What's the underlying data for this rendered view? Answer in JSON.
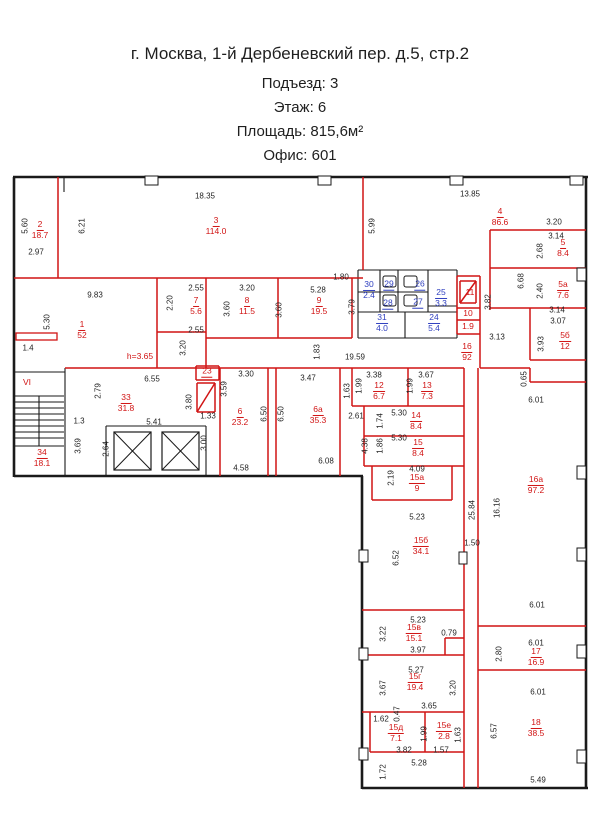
{
  "header": {
    "line1": "г. Москва, 1-й Дербеневский пер. д.5, стр.2",
    "line2": "Подъезд: 3",
    "line3": "Этаж: 6",
    "line4": "Площадь: 815,6м²",
    "line5": "Офис: 601"
  },
  "colors": {
    "wall_black": "#1a1a1a",
    "wall_red": "#d11414",
    "label_red": "#d11414",
    "label_blue": "#2f3fbf",
    "dim_text": "#1f1f1f"
  },
  "plan": {
    "walls_black_thick": [
      [
        13,
        177,
        588,
        177
      ],
      [
        14,
        177,
        14,
        477
      ],
      [
        14,
        476,
        363,
        476
      ],
      [
        362,
        476,
        362,
        789
      ],
      [
        362,
        788,
        588,
        788
      ],
      [
        586,
        177,
        586,
        788
      ]
    ],
    "walls_black_thin": [
      [
        64,
        177,
        64,
        192
      ],
      [
        65,
        368,
        65,
        476
      ],
      [
        14,
        372,
        65,
        372
      ],
      [
        14,
        396,
        64,
        396
      ],
      [
        14,
        446,
        64,
        446
      ],
      [
        39,
        396,
        39,
        446
      ],
      [
        14,
        402,
        64,
        402
      ],
      [
        14,
        408,
        64,
        408
      ],
      [
        14,
        414,
        64,
        414
      ],
      [
        14,
        420,
        64,
        420
      ],
      [
        14,
        426,
        64,
        426
      ],
      [
        14,
        432,
        64,
        432
      ],
      [
        14,
        438,
        64,
        438
      ],
      [
        106,
        426,
        206,
        426
      ],
      [
        106,
        426,
        106,
        476
      ],
      [
        206,
        426,
        206,
        476
      ],
      [
        358,
        270,
        457,
        270
      ],
      [
        358,
        270,
        358,
        338
      ],
      [
        358,
        338,
        457,
        338
      ],
      [
        457,
        270,
        457,
        338
      ],
      [
        380,
        270,
        380,
        312
      ],
      [
        398,
        270,
        398,
        312
      ],
      [
        428,
        270,
        428,
        312
      ],
      [
        358,
        292,
        428,
        292
      ],
      [
        358,
        312,
        457,
        312
      ],
      [
        405,
        312,
        405,
        338
      ],
      [
        428,
        306,
        457,
        306
      ]
    ],
    "walls_red": [
      [
        58,
        177,
        58,
        278
      ],
      [
        14,
        278,
        363,
        278
      ],
      [
        157,
        278,
        157,
        368
      ],
      [
        206,
        278,
        206,
        368
      ],
      [
        278,
        278,
        278,
        338
      ],
      [
        352,
        278,
        352,
        338
      ],
      [
        206,
        338,
        352,
        338
      ],
      [
        157,
        332,
        206,
        332
      ],
      [
        65,
        368,
        464,
        368
      ],
      [
        363,
        177,
        363,
        270
      ],
      [
        457,
        276,
        480,
        276
      ],
      [
        480,
        276,
        480,
        334
      ],
      [
        457,
        334,
        480,
        334
      ],
      [
        457,
        308,
        480,
        308
      ],
      [
        457,
        320,
        480,
        320
      ],
      [
        457,
        276,
        457,
        334
      ],
      [
        460,
        281,
        476,
        281
      ],
      [
        460,
        281,
        460,
        303
      ],
      [
        476,
        281,
        476,
        303
      ],
      [
        460,
        303,
        476,
        303
      ],
      [
        460,
        303,
        476,
        281
      ],
      [
        490,
        230,
        586,
        230
      ],
      [
        490,
        230,
        490,
        310
      ],
      [
        490,
        268,
        586,
        268
      ],
      [
        490,
        308,
        586,
        308
      ],
      [
        530,
        308,
        530,
        360
      ],
      [
        530,
        360,
        586,
        360
      ],
      [
        480,
        334,
        480,
        368
      ],
      [
        480,
        368,
        530,
        368
      ],
      [
        530,
        368,
        530,
        382
      ],
      [
        530,
        382,
        586,
        382
      ],
      [
        220,
        368,
        220,
        476
      ],
      [
        196,
        366,
        219,
        366
      ],
      [
        196,
        366,
        196,
        380
      ],
      [
        219,
        366,
        219,
        380
      ],
      [
        196,
        380,
        219,
        380
      ],
      [
        197,
        383,
        215,
        383
      ],
      [
        197,
        383,
        197,
        412
      ],
      [
        215,
        383,
        215,
        412
      ],
      [
        197,
        412,
        215,
        412
      ],
      [
        197,
        412,
        215,
        383
      ],
      [
        268,
        368,
        268,
        476
      ],
      [
        276,
        368,
        276,
        476
      ],
      [
        340,
        368,
        340,
        476
      ],
      [
        352,
        368,
        352,
        406
      ],
      [
        408,
        368,
        408,
        406
      ],
      [
        352,
        406,
        464,
        406
      ],
      [
        364,
        406,
        364,
        466
      ],
      [
        364,
        436,
        464,
        436
      ],
      [
        364,
        466,
        464,
        466
      ],
      [
        372,
        466,
        372,
        500
      ],
      [
        452,
        466,
        452,
        500
      ],
      [
        372,
        500,
        452,
        500
      ],
      [
        464,
        368,
        464,
        788
      ],
      [
        478,
        368,
        478,
        788
      ],
      [
        362,
        610,
        464,
        610
      ],
      [
        362,
        655,
        464,
        655
      ],
      [
        445,
        638,
        445,
        655
      ],
      [
        445,
        638,
        464,
        638
      ],
      [
        362,
        712,
        464,
        712
      ],
      [
        370,
        712,
        370,
        752
      ],
      [
        425,
        712,
        425,
        752
      ],
      [
        370,
        752,
        464,
        752
      ],
      [
        478,
        626,
        586,
        626
      ],
      [
        478,
        670,
        586,
        670
      ]
    ],
    "boxes_red": [
      {
        "x": 16,
        "y": 333,
        "w": 41,
        "h": 7
      }
    ],
    "tabs": [
      {
        "x": 145,
        "y": 176,
        "w": 13,
        "h": 9
      },
      {
        "x": 318,
        "y": 176,
        "w": 13,
        "h": 9
      },
      {
        "x": 450,
        "y": 176,
        "w": 13,
        "h": 9
      },
      {
        "x": 570,
        "y": 176,
        "w": 13,
        "h": 9
      },
      {
        "x": 577,
        "y": 268,
        "w": 9,
        "h": 13
      },
      {
        "x": 577,
        "y": 466,
        "w": 9,
        "h": 13
      },
      {
        "x": 577,
        "y": 548,
        "w": 9,
        "h": 13
      },
      {
        "x": 577,
        "y": 645,
        "w": 9,
        "h": 13
      },
      {
        "x": 577,
        "y": 750,
        "w": 9,
        "h": 13
      },
      {
        "x": 359,
        "y": 550,
        "w": 9,
        "h": 12
      },
      {
        "x": 359,
        "y": 648,
        "w": 9,
        "h": 12
      },
      {
        "x": 359,
        "y": 748,
        "w": 9,
        "h": 12
      },
      {
        "x": 459,
        "y": 552,
        "w": 8,
        "h": 12
      }
    ],
    "elevators": [
      {
        "x": 114,
        "y": 432,
        "w": 37,
        "h": 38
      },
      {
        "x": 162,
        "y": 432,
        "w": 37,
        "h": 38
      }
    ],
    "fixtures": [
      {
        "x": 383,
        "y": 276,
        "w": 13,
        "h": 11
      },
      {
        "x": 404,
        "y": 276,
        "w": 13,
        "h": 11
      },
      {
        "x": 383,
        "y": 295,
        "w": 13,
        "h": 11
      },
      {
        "x": 404,
        "y": 295,
        "w": 13,
        "h": 11
      }
    ],
    "rooms": [
      {
        "n": "2",
        "a": "18.7",
        "x": 40,
        "y": 230,
        "c": "r"
      },
      {
        "n": "3",
        "a": "114.0",
        "x": 216,
        "y": 226,
        "c": "r"
      },
      {
        "n": "4",
        "a": "86.6",
        "x": 500,
        "y": 217,
        "c": "r"
      },
      {
        "n": "5",
        "a": "8.4",
        "x": 563,
        "y": 248,
        "c": "r"
      },
      {
        "n": "5а",
        "a": "7.6",
        "x": 563,
        "y": 290,
        "c": "r"
      },
      {
        "n": "5б",
        "a": "12",
        "x": 565,
        "y": 341,
        "c": "r"
      },
      {
        "n": "1",
        "a": "52",
        "x": 82,
        "y": 330,
        "c": "r"
      },
      {
        "n": "7",
        "a": "5.6",
        "x": 196,
        "y": 306,
        "c": "r"
      },
      {
        "n": "8",
        "a": "11.5",
        "x": 247,
        "y": 306,
        "c": "r"
      },
      {
        "n": "9",
        "a": "19.5",
        "x": 319,
        "y": 306,
        "c": "r"
      },
      {
        "n": "11",
        "a": "",
        "x": 470,
        "y": 293,
        "c": "r"
      },
      {
        "n": "10",
        "a": "",
        "x": 468,
        "y": 314,
        "c": "r"
      },
      {
        "n": "1.9",
        "a": "",
        "x": 468,
        "y": 327,
        "c": "r"
      },
      {
        "n": "16",
        "a": "92",
        "x": 467,
        "y": 352,
        "c": "r"
      },
      {
        "n": "30",
        "a": "2.4",
        "x": 369,
        "y": 290,
        "c": "b"
      },
      {
        "n": "29",
        "a": "",
        "u": true,
        "x": 389,
        "y": 285,
        "c": "b"
      },
      {
        "n": "26",
        "a": "",
        "u": true,
        "x": 420,
        "y": 285,
        "c": "b"
      },
      {
        "n": "25",
        "a": "3.3",
        "x": 441,
        "y": 298,
        "c": "b"
      },
      {
        "n": "28",
        "a": "",
        "u": true,
        "x": 388,
        "y": 304,
        "c": "b"
      },
      {
        "n": "27",
        "a": "",
        "u": true,
        "x": 418,
        "y": 303,
        "c": "b"
      },
      {
        "n": "31",
        "a": "4.0",
        "x": 382,
        "y": 323,
        "c": "b"
      },
      {
        "n": "24",
        "a": "5.4",
        "x": 434,
        "y": 323,
        "c": "b"
      },
      {
        "n": "23",
        "a": "",
        "u": true,
        "x": 207,
        "y": 372,
        "c": "r"
      },
      {
        "n": "33",
        "a": "31.8",
        "x": 126,
        "y": 403,
        "c": "r"
      },
      {
        "n": "34",
        "a": "18.1",
        "x": 42,
        "y": 458,
        "c": "r"
      },
      {
        "n": "6",
        "a": "23.2",
        "x": 240,
        "y": 417,
        "c": "r"
      },
      {
        "n": "6а",
        "a": "35.3",
        "x": 318,
        "y": 415,
        "c": "r"
      },
      {
        "n": "12",
        "a": "6.7",
        "x": 379,
        "y": 391,
        "c": "r"
      },
      {
        "n": "13",
        "a": "7.3",
        "x": 427,
        "y": 391,
        "c": "r"
      },
      {
        "n": "14",
        "a": "8.4",
        "x": 416,
        "y": 421,
        "c": "r"
      },
      {
        "n": "15",
        "a": "8.4",
        "x": 418,
        "y": 448,
        "c": "r"
      },
      {
        "n": "15а",
        "a": "9",
        "x": 417,
        "y": 483,
        "c": "r"
      },
      {
        "n": "15б",
        "a": "34.1",
        "x": 421,
        "y": 546,
        "c": "r"
      },
      {
        "n": "16а",
        "a": "97.2",
        "x": 536,
        "y": 485,
        "c": "r"
      },
      {
        "n": "15в",
        "a": "15.1",
        "x": 414,
        "y": 633,
        "c": "r"
      },
      {
        "n": "15г",
        "a": "19.4",
        "x": 415,
        "y": 682,
        "c": "r"
      },
      {
        "n": "15д",
        "a": "7.1",
        "x": 396,
        "y": 733,
        "c": "r"
      },
      {
        "n": "15е",
        "a": "2.8",
        "x": 444,
        "y": 731,
        "c": "r"
      },
      {
        "n": "17",
        "a": "16.9",
        "x": 536,
        "y": 657,
        "c": "r"
      },
      {
        "n": "18",
        "a": "38.5",
        "x": 536,
        "y": 728,
        "c": "r"
      }
    ],
    "dims": [
      [
        "5.60",
        25,
        226,
        1
      ],
      [
        "2.97",
        36,
        252,
        0
      ],
      [
        "6.21",
        82,
        226,
        1
      ],
      [
        "18.35",
        205,
        196,
        0
      ],
      [
        "13.85",
        470,
        194,
        0
      ],
      [
        "5.99",
        372,
        226,
        1
      ],
      [
        "3.20",
        554,
        222,
        0
      ],
      [
        "3.14",
        556,
        236,
        0
      ],
      [
        "2.68",
        540,
        251,
        1
      ],
      [
        "6.68",
        521,
        281,
        1
      ],
      [
        "2.40",
        540,
        291,
        1
      ],
      [
        "3.14",
        557,
        310,
        0
      ],
      [
        "3.07",
        558,
        321,
        0
      ],
      [
        "3.93",
        541,
        344,
        1
      ],
      [
        "3.82",
        488,
        302,
        1
      ],
      [
        "3.13",
        497,
        337,
        0
      ],
      [
        "0.65",
        524,
        379,
        1
      ],
      [
        "6.01",
        536,
        400,
        0
      ],
      [
        "9.83",
        95,
        295,
        0
      ],
      [
        "5.30",
        47,
        322,
        1
      ],
      [
        "1.4",
        28,
        348,
        0
      ],
      [
        "2.55",
        196,
        288,
        0
      ],
      [
        "2.20",
        170,
        303,
        1
      ],
      [
        "2.55",
        196,
        330,
        0
      ],
      [
        "3.20",
        183,
        348,
        1
      ],
      [
        "3.20",
        247,
        288,
        0
      ],
      [
        "3.60",
        227,
        309,
        1
      ],
      [
        "5.28",
        318,
        290,
        0
      ],
      [
        "3.60",
        279,
        310,
        1
      ],
      [
        "3.79",
        352,
        307,
        1
      ],
      [
        "1.80",
        341,
        277,
        0
      ],
      [
        "1.83",
        317,
        352,
        1
      ],
      [
        "19.59",
        355,
        357,
        0
      ],
      [
        "6.55",
        152,
        379,
        0
      ],
      [
        "2.79",
        98,
        391,
        1
      ],
      [
        "1.3",
        79,
        421,
        0
      ],
      [
        "3.80",
        189,
        402,
        1
      ],
      [
        "5.41",
        154,
        422,
        0
      ],
      [
        "3.69",
        78,
        446,
        1
      ],
      [
        "2.64",
        106,
        449,
        1
      ],
      [
        "3.00",
        204,
        443,
        1
      ],
      [
        "3.30",
        246,
        374,
        0
      ],
      [
        "3.59",
        224,
        389,
        1
      ],
      [
        "1.33",
        208,
        416,
        0
      ],
      [
        "3.47",
        308,
        378,
        0
      ],
      [
        "6.50",
        264,
        414,
        1
      ],
      [
        "6.50",
        281,
        414,
        1
      ],
      [
        "4.58",
        241,
        468,
        0
      ],
      [
        "6.08",
        326,
        461,
        0
      ],
      [
        "1.63",
        347,
        391,
        1
      ],
      [
        "1.99",
        359,
        386,
        1
      ],
      [
        "3.38",
        374,
        375,
        0
      ],
      [
        "1.99",
        410,
        386,
        1
      ],
      [
        "3.67",
        426,
        375,
        0
      ],
      [
        "2.61",
        356,
        416,
        0
      ],
      [
        "1.74",
        380,
        421,
        1
      ],
      [
        "5.30",
        399,
        413,
        0
      ],
      [
        "4.38",
        365,
        446,
        1
      ],
      [
        "1.86",
        380,
        446,
        1
      ],
      [
        "5.30",
        399,
        438,
        0
      ],
      [
        "4.09",
        417,
        469,
        0
      ],
      [
        "2.19",
        391,
        478,
        1
      ],
      [
        "5.23",
        417,
        517,
        0
      ],
      [
        "25.84",
        472,
        510,
        1
      ],
      [
        "16.16",
        497,
        508,
        1
      ],
      [
        "1.50",
        472,
        543,
        0
      ],
      [
        "6.52",
        396,
        558,
        1
      ],
      [
        "5.23",
        418,
        620,
        0
      ],
      [
        "3.22",
        383,
        634,
        1
      ],
      [
        "0.79",
        449,
        633,
        0
      ],
      [
        "3.97",
        418,
        650,
        0
      ],
      [
        "5.27",
        416,
        670,
        0
      ],
      [
        "3.67",
        383,
        688,
        1
      ],
      [
        "3.20",
        453,
        688,
        1
      ],
      [
        "3.65",
        429,
        706,
        0
      ],
      [
        "1.62",
        381,
        719,
        0
      ],
      [
        "0.47",
        397,
        714,
        1
      ],
      [
        "1.99",
        424,
        734,
        1
      ],
      [
        "1.63",
        458,
        735,
        1
      ],
      [
        "3.82",
        404,
        750,
        0
      ],
      [
        "1.57",
        441,
        750,
        0
      ],
      [
        "5.28",
        419,
        763,
        0
      ],
      [
        "1.72",
        383,
        772,
        1
      ],
      [
        "6.01",
        537,
        605,
        0
      ],
      [
        "6.01",
        536,
        643,
        0
      ],
      [
        "2.80",
        499,
        654,
        1
      ],
      [
        "6.01",
        538,
        692,
        0
      ],
      [
        "6.57",
        494,
        731,
        1
      ],
      [
        "5.49",
        538,
        780,
        0
      ]
    ],
    "notes": [
      {
        "t": "h=3.65",
        "x": 140,
        "y": 356,
        "c": "r"
      },
      {
        "t": "VI",
        "x": 27,
        "y": 382,
        "c": "r"
      }
    ]
  }
}
